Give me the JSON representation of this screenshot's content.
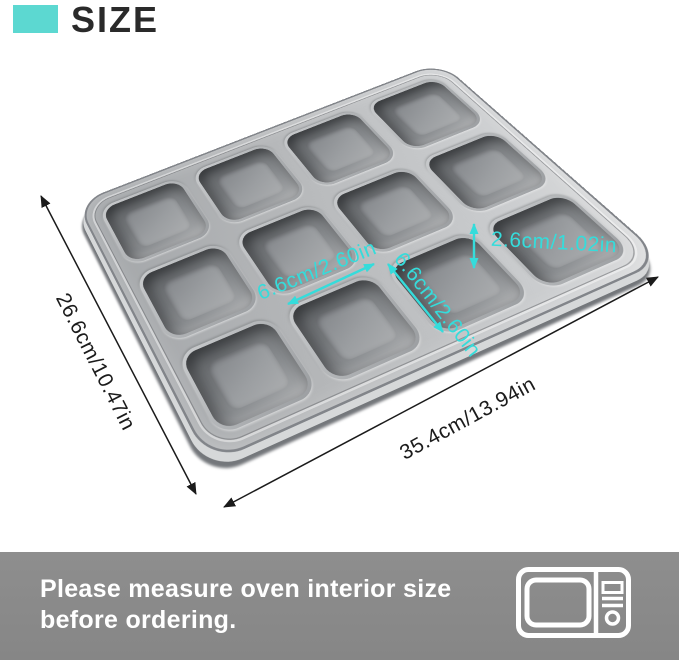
{
  "header": {
    "title": "SIZE",
    "accent_color": "#5CD8D1"
  },
  "pan": {
    "rows": 3,
    "cols": 4,
    "cavity_count": 12
  },
  "dimensions": {
    "overall_length": "35.4cm/13.94in",
    "overall_width": "26.6cm/10.47in",
    "cavity_width": "6.6cm/2.60in",
    "cavity_length": "6.6cm/2.60in",
    "cavity_depth": "2.6cm/1.02in",
    "annotation_color": "#35DCDB",
    "line_color": "#1B1B1B"
  },
  "footer": {
    "line1": "Please measure oven interior size",
    "line2": "before ordering.",
    "icon": "microwave-icon",
    "background": "#8A8A8A",
    "text_color": "#FFFFFF"
  }
}
